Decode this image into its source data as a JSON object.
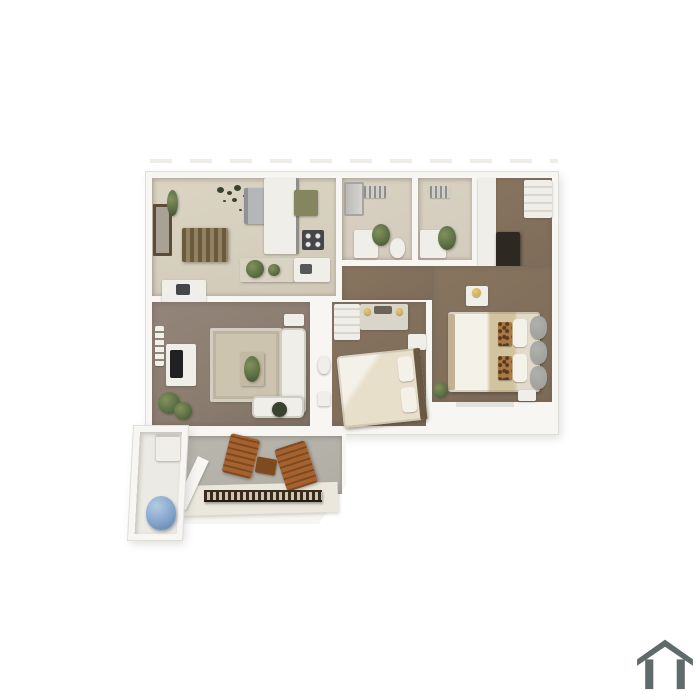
{
  "page": {
    "background_color": "#ffffff"
  },
  "logo": {
    "icon": "house-outline-icon",
    "color": "#5f6b6b"
  },
  "floorplan": {
    "description": "3D rendered top-down floor plan of a two-bedroom, two-bath apartment with living room, dining room, kitchen, hallway, walk-in closet, patio with two wooden chairs, and exterior storage closet",
    "colors": {
      "page_bg": "#ffffff",
      "wall": "#f7f6f3",
      "wall_shade": "#deddd8",
      "tile_floor": "#d6cfbe",
      "bath_floor": "#d3ccbd",
      "carpet": "#8a7c6e",
      "carpet_dark": "#7c6a59",
      "rug": "#cdc4b0",
      "white_furniture": "#efeee8",
      "dark_appliance": "#45464a",
      "steel_appliance": "#b4b6b9",
      "counter_green": "#83865f",
      "wood_table": "#6a5a3e",
      "wood_table_light": "#93825f",
      "wood_chair": "#a5622f",
      "wood_chair_dark": "#7e4a20",
      "railing_dark": "#3a2c1d",
      "bed_cream": "#e7dfca",
      "sheet_white": "#f4f1e8",
      "blanket_tan": "#d3c4a0",
      "leopard_base": "#a97a48",
      "leopard_spot": "#5c3a1e",
      "cushion_gray": "#9b9b97",
      "headboard_wood": "#6a5845",
      "plant_green": "#5d7045",
      "plant_dark": "#39422e",
      "blue_item": "#84a4ca",
      "patio_floor": "#b0ada5",
      "patio_light": "#eae7dd",
      "frame_brown": "#5d4c38",
      "dresser_dark": "#2e2823",
      "icon_gray": "#5f6b6b",
      "gold": "#c9a23f",
      "tv_dark": "#1f2022"
    },
    "rooms": [
      {
        "id": "dining-kitchen",
        "floor": "tile",
        "items": [
          "picture-frame",
          "wall-plant",
          "leaf-wall-decor",
          "dining-table",
          "desk",
          "refrigerator",
          "kitchen-cabinets",
          "green-counter",
          "stove",
          "kitchen-island",
          "sink-peninsula"
        ]
      },
      {
        "id": "bathroom-1",
        "floor": "tile",
        "items": [
          "shower",
          "wall-vent",
          "vanity",
          "plant",
          "toilet"
        ]
      },
      {
        "id": "bathroom-2",
        "floor": "tile",
        "items": [
          "wall-vent",
          "vanity",
          "plant"
        ]
      },
      {
        "id": "closet-room",
        "floor": "carpet",
        "items": [
          "shelving",
          "dark-dresser"
        ]
      },
      {
        "id": "hallway",
        "floor": "carpet",
        "items": []
      },
      {
        "id": "living-room",
        "floor": "carpet",
        "items": [
          "wall-sign",
          "tv-console",
          "tv",
          "plant-cluster",
          "area-rug",
          "coffee-table-plant",
          "sectional-sofa",
          "chaise",
          "side-table",
          "dark-planter"
        ]
      },
      {
        "id": "bedroom-2",
        "floor": "carpet",
        "items": [
          "closet",
          "dresser-with-lamps",
          "bed-cream",
          "nightstand",
          "wall-nook-toilet"
        ]
      },
      {
        "id": "master-bedroom",
        "floor": "carpet",
        "items": [
          "nightstand-lamp",
          "bed-tan",
          "leopard-pillows",
          "white-pillows",
          "gray-headboard-cushions",
          "bench",
          "corner-plant"
        ]
      },
      {
        "id": "patio",
        "floor": "concrete",
        "items": [
          "wooden-chair",
          "wooden-chair",
          "wooden-side-table",
          "railing",
          "diagonal-wall"
        ]
      },
      {
        "id": "storage-closet",
        "floor": "concrete",
        "items": [
          "water-heater-box",
          "blue-cover-item"
        ]
      }
    ]
  }
}
